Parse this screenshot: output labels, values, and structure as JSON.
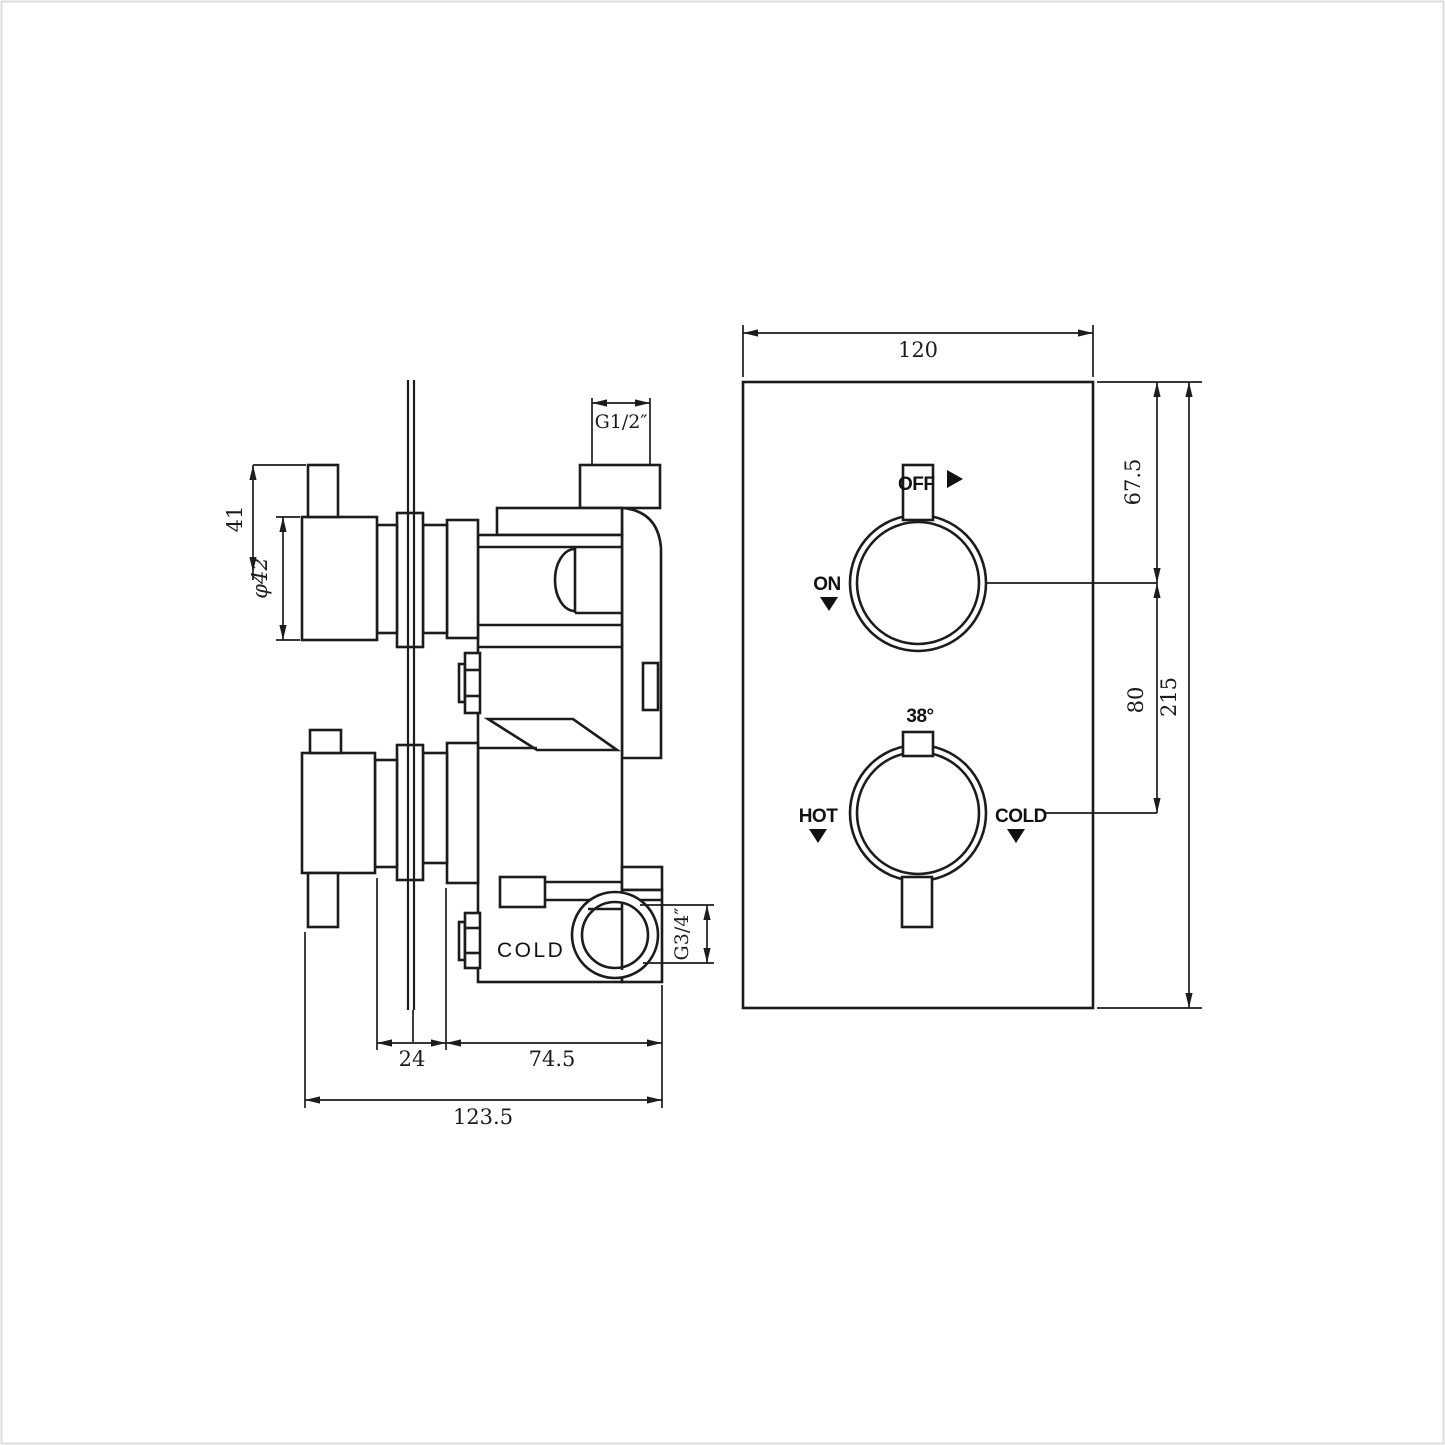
{
  "side_view": {
    "dims": {
      "handle_height": "41",
      "knob_diameter": "φ42",
      "outlet_thread": "G1/2″",
      "inlet_thread": "G3/4″",
      "plate_to_body": "24",
      "body_depth": "74.5",
      "total_depth": "123.5"
    },
    "labels": {
      "cold_port": "COLD"
    }
  },
  "front_view": {
    "dims": {
      "plate_width": "120",
      "top_to_first_knob": "67.5",
      "knob_spacing": "80",
      "plate_height": "215"
    },
    "knob_on_off": {
      "off": "OFF",
      "on": "ON"
    },
    "knob_temp": {
      "temperature": "38°",
      "hot": "HOT",
      "cold": "COLD"
    }
  }
}
